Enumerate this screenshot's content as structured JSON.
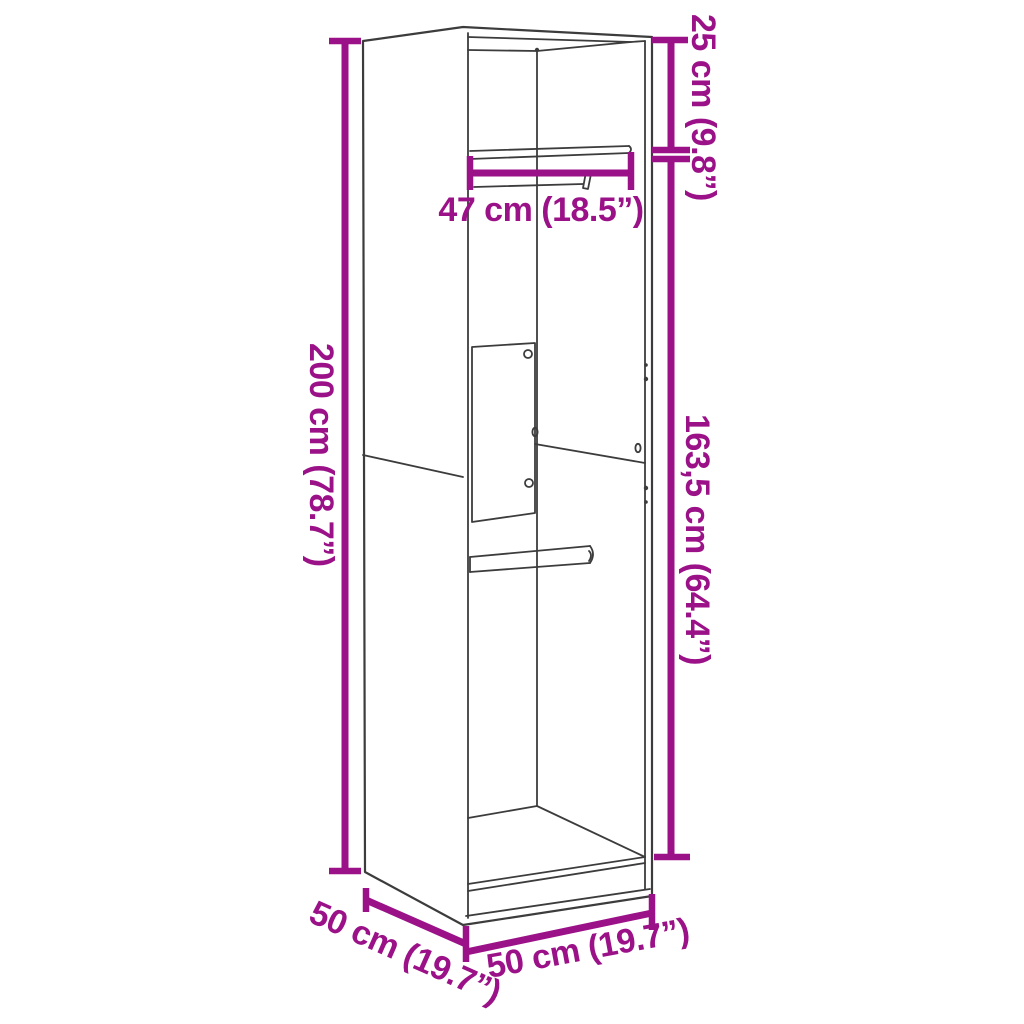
{
  "meta": {
    "description": "Technical line drawing of an open wardrobe cabinet with interior hanging rails, annotated with magenta dimension lines"
  },
  "colors": {
    "accent": "#9B1188",
    "line": "#3C3C3C",
    "background": "#FFFFFF"
  },
  "labels": {
    "height_total": "200 cm (78.7”)",
    "top_section": "25 cm (9.8”)",
    "lower_section": "163,5 cm (64.4”)",
    "rail_width": "47 cm (18.5”)",
    "depth": "50 cm (19.7”)",
    "width": "50 cm (19.7”)"
  }
}
